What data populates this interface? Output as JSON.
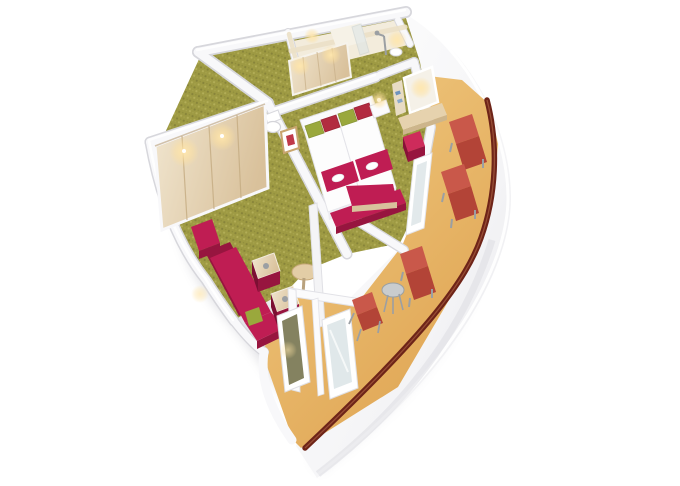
{
  "scene": {
    "type": "cruise-cabin-3d-floorplan-render",
    "view": "isometric-cutaway",
    "rooms": [
      "bathroom",
      "corridor-with-closet",
      "bedroom",
      "living-area",
      "curved-balcony"
    ],
    "furniture_counts": {
      "beds": 2,
      "bed_pillows": 4,
      "bed_runners": 2,
      "foot_bench": 1,
      "wardrobe_doors": 4,
      "sofa_sections": 3,
      "cube_side_tables": 2,
      "round_table": 1,
      "desk_with_mirror": 1,
      "desk_stool": 1,
      "deck_loungers": 3,
      "balcony_chair": 1,
      "balcony_table": 1
    }
  },
  "colors": {
    "background": "#ffffff",
    "wall_white": "#f8f8fa",
    "wall_shadow": "#d7d7dc",
    "wall_cream": "#ebe0c6",
    "carpet_base": "#9e9a43",
    "carpet_dot_dark": "#87843a",
    "carpet_dot_light": "#b3ae57",
    "accent_magenta": "#bf1d53",
    "accent_magenta_dark": "#97153f",
    "lounger_red": "#c9584a",
    "lounger_red_dark": "#b34437",
    "balcony_floor_light": "#f2cd85",
    "balcony_floor": "#dfa452",
    "railing": "#6e2418",
    "wood_light": "#ecdfc6",
    "wood_mid": "#dcc5a0",
    "glass": "#dbe4e6",
    "glow": "#ffdf9f",
    "metal": "#9b9fa3",
    "pillow_green": "#9aa83c",
    "pillow_red": "#b22b40",
    "mattress_white": "#fdfdfd",
    "bathroom_floor": "#f3ecdc"
  }
}
